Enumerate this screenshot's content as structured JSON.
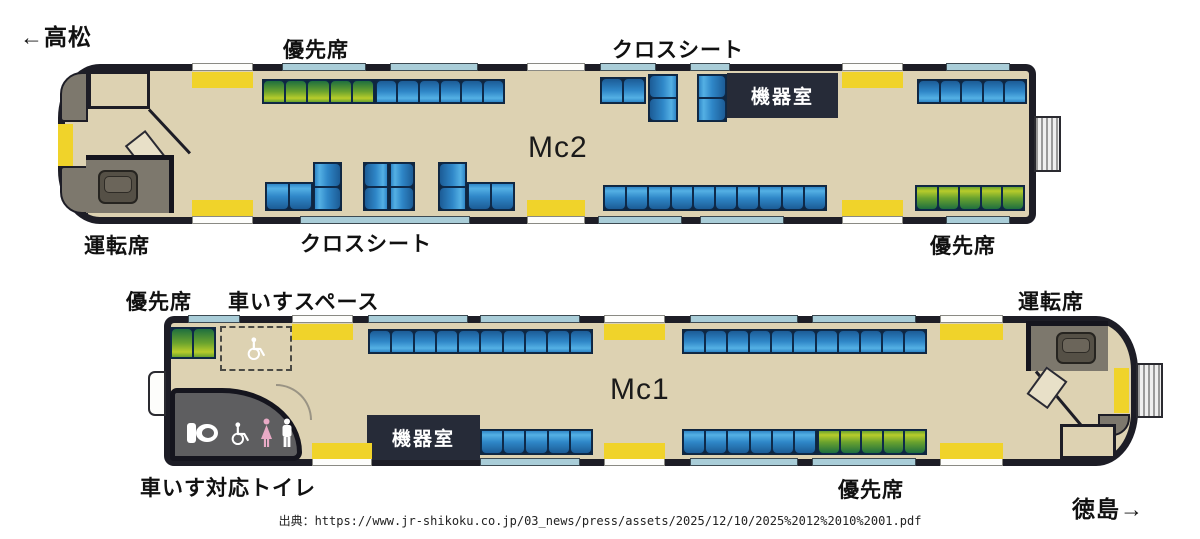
{
  "header": {
    "to_takamatsu": "←高松",
    "to_tokushima": "徳島→"
  },
  "cars": {
    "mc2": {
      "name": "Mc2",
      "labels": {
        "priority_top": "優先席",
        "cross_top": "クロスシート",
        "equipment": "機器室",
        "driver": "運転席",
        "cross_bottom": "クロスシート",
        "priority_right": "優先席"
      }
    },
    "mc1": {
      "name": "Mc1",
      "labels": {
        "priority_left": "優先席",
        "wheelchair_space": "車いすスペース",
        "driver": "運転席",
        "equipment": "機器室",
        "toilet": "車いす対応トイレ",
        "priority_bottom": "優先席"
      }
    }
  },
  "source_line": "出典：https://www.jr-shikoku.co.jp/03_news/press/assets/2025/12/10/2025%2012%2010%2001.pdf",
  "colors": {
    "floor": "#ddd2b2",
    "wall": "#1d1d26",
    "door": "#f0d32a",
    "window": "#a9cdd8",
    "equip": "#262b38",
    "cab": "#7d786d",
    "toilet": "#5e5e60",
    "seat_blue": [
      "#1c5c96",
      "#2f87c8",
      "#54b0e4"
    ],
    "seat_green": [
      "#1f6f3f",
      "#6aa32e",
      "#b8cc2b"
    ],
    "woman_pink": "#e9aac6"
  },
  "seat_map": {
    "benches": [
      {
        "car": "mc2",
        "kind": "green",
        "x": 262,
        "y": 79,
        "w": 113,
        "h": 25,
        "dir": "up",
        "seats": 5
      },
      {
        "car": "mc2",
        "kind": "blue",
        "x": 375,
        "y": 79,
        "w": 130,
        "h": 25,
        "dir": "up",
        "seats": 6
      },
      {
        "car": "mc2",
        "kind": "blue",
        "x": 600,
        "y": 77,
        "w": 46,
        "h": 27,
        "dir": "up",
        "seats": 2
      },
      {
        "car": "mc2",
        "kind": "blue",
        "x": 648,
        "y": 74,
        "w": 30,
        "h": 48,
        "dir": "right",
        "seats": 2
      },
      {
        "car": "mc2",
        "kind": "blue",
        "x": 697,
        "y": 74,
        "w": 30,
        "h": 48,
        "dir": "left",
        "seats": 2
      },
      {
        "car": "mc2",
        "kind": "blue",
        "x": 917,
        "y": 79,
        "w": 110,
        "h": 25,
        "dir": "up",
        "seats": 5
      },
      {
        "car": "mc2",
        "kind": "blue",
        "x": 265,
        "y": 182,
        "w": 48,
        "h": 29,
        "dir": "down",
        "seats": 2
      },
      {
        "car": "mc2",
        "kind": "blue",
        "x": 313,
        "y": 162,
        "w": 29,
        "h": 49,
        "dir": "left",
        "seats": 2
      },
      {
        "car": "mc2",
        "kind": "blue",
        "x": 363,
        "y": 162,
        "w": 26,
        "h": 49,
        "dir": "right",
        "seats": 2
      },
      {
        "car": "mc2",
        "kind": "blue",
        "x": 389,
        "y": 162,
        "w": 26,
        "h": 49,
        "dir": "left",
        "seats": 2
      },
      {
        "car": "mc2",
        "kind": "blue",
        "x": 438,
        "y": 162,
        "w": 29,
        "h": 49,
        "dir": "right",
        "seats": 2
      },
      {
        "car": "mc2",
        "kind": "blue",
        "x": 467,
        "y": 182,
        "w": 48,
        "h": 29,
        "dir": "down",
        "seats": 2
      },
      {
        "car": "mc2",
        "kind": "blue",
        "x": 603,
        "y": 185,
        "w": 224,
        "h": 26,
        "dir": "down",
        "seats": 10
      },
      {
        "car": "mc2",
        "kind": "green",
        "x": 915,
        "y": 185,
        "w": 110,
        "h": 26,
        "dir": "down",
        "seats": 5
      },
      {
        "car": "mc1",
        "kind": "green",
        "x": 170,
        "y": 327,
        "w": 46,
        "h": 32,
        "dir": "up",
        "seats": 2
      },
      {
        "car": "mc1",
        "kind": "blue",
        "x": 368,
        "y": 329,
        "w": 225,
        "h": 25,
        "dir": "up",
        "seats": 10
      },
      {
        "car": "mc1",
        "kind": "blue",
        "x": 682,
        "y": 329,
        "w": 245,
        "h": 25,
        "dir": "up",
        "seats": 11
      },
      {
        "car": "mc1",
        "kind": "blue",
        "x": 480,
        "y": 429,
        "w": 113,
        "h": 26,
        "dir": "down",
        "seats": 5
      },
      {
        "car": "mc1",
        "kind": "blue",
        "x": 682,
        "y": 429,
        "w": 135,
        "h": 26,
        "dir": "down",
        "seats": 6
      },
      {
        "car": "mc1",
        "kind": "green",
        "x": 817,
        "y": 429,
        "w": 110,
        "h": 26,
        "dir": "down",
        "seats": 5
      }
    ],
    "door_pads": [
      {
        "x": 192,
        "y": 72,
        "w": 61,
        "h": 16
      },
      {
        "x": 842,
        "y": 72,
        "w": 61,
        "h": 16
      },
      {
        "x": 192,
        "y": 200,
        "w": 61,
        "h": 16
      },
      {
        "x": 527,
        "y": 200,
        "w": 58,
        "h": 16
      },
      {
        "x": 842,
        "y": 200,
        "w": 61,
        "h": 16
      },
      {
        "x": 292,
        "y": 324,
        "w": 61,
        "h": 16
      },
      {
        "x": 604,
        "y": 324,
        "w": 61,
        "h": 16
      },
      {
        "x": 940,
        "y": 324,
        "w": 63,
        "h": 16
      },
      {
        "x": 312,
        "y": 443,
        "w": 60,
        "h": 16
      },
      {
        "x": 604,
        "y": 443,
        "w": 61,
        "h": 16
      },
      {
        "x": 940,
        "y": 443,
        "w": 63,
        "h": 16
      }
    ],
    "windows": [
      {
        "x": 282,
        "y": 63,
        "w": 84
      },
      {
        "x": 390,
        "y": 63,
        "w": 88
      },
      {
        "x": 600,
        "y": 63,
        "w": 56
      },
      {
        "x": 690,
        "y": 63,
        "w": 40
      },
      {
        "x": 946,
        "y": 63,
        "w": 64
      },
      {
        "x": 300,
        "y": 216,
        "w": 170
      },
      {
        "x": 598,
        "y": 216,
        "w": 84
      },
      {
        "x": 700,
        "y": 216,
        "w": 84
      },
      {
        "x": 946,
        "y": 216,
        "w": 64
      },
      {
        "x": 188,
        "y": 315,
        "w": 52
      },
      {
        "x": 368,
        "y": 315,
        "w": 100
      },
      {
        "x": 480,
        "y": 315,
        "w": 100
      },
      {
        "x": 690,
        "y": 315,
        "w": 108
      },
      {
        "x": 812,
        "y": 315,
        "w": 104
      },
      {
        "x": 480,
        "y": 458,
        "w": 100
      },
      {
        "x": 690,
        "y": 458,
        "w": 108
      },
      {
        "x": 812,
        "y": 458,
        "w": 104
      }
    ],
    "openings": [
      {
        "x": 192,
        "y": 63,
        "w": 61
      },
      {
        "x": 527,
        "y": 63,
        "w": 58
      },
      {
        "x": 842,
        "y": 63,
        "w": 61
      },
      {
        "x": 192,
        "y": 216,
        "w": 61
      },
      {
        "x": 527,
        "y": 216,
        "w": 58
      },
      {
        "x": 842,
        "y": 216,
        "w": 61
      },
      {
        "x": 292,
        "y": 315,
        "w": 61
      },
      {
        "x": 604,
        "y": 315,
        "w": 61
      },
      {
        "x": 940,
        "y": 315,
        "w": 63
      },
      {
        "x": 312,
        "y": 458,
        "w": 60
      },
      {
        "x": 604,
        "y": 458,
        "w": 61
      },
      {
        "x": 940,
        "y": 458,
        "w": 63
      }
    ]
  }
}
